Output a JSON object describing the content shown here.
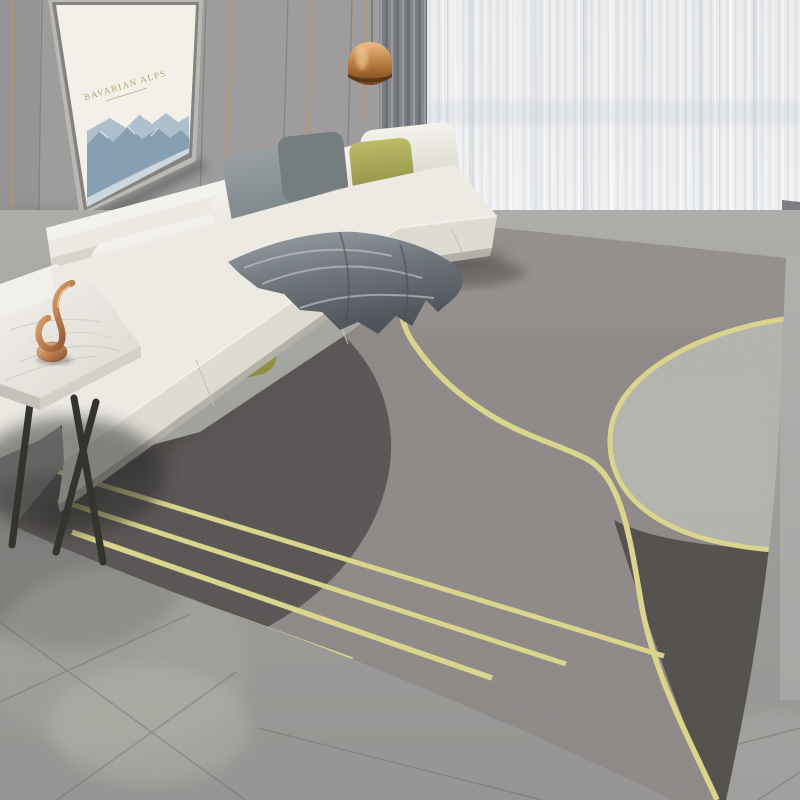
{
  "scene": {
    "type": "photograph",
    "description": "Modern living room: white L-shaped sectional sofa with grey and olive pillows, satin grey throw, framed mountain print on panelled grey wall, copper pendant lamp, grey and sheer white curtains, marble side table with gold sculpture, large grey geometric area rug with gold curved and straight lines on polished grey tile floor"
  },
  "artwork": {
    "title": "BAVARIAN ALPS"
  },
  "objects": {
    "wall_art": "framed mountain print",
    "pendant_lamp": "copper pendant lamp",
    "sofa": "white sectional sofa",
    "throw": "grey satin throw blanket",
    "rug": "grey geometric rug with gold lines",
    "side_table": "marble top side table",
    "ornament": "gold abstract sculpture",
    "curtain_left": "grey drape",
    "curtain_right": "sheer white curtain",
    "floor": "polished grey tile floor"
  },
  "palette": {
    "wall": "#9e9c9d",
    "wallSeam": "#7b797a",
    "goldTrim": "#b99763",
    "artMat": "#f3f0ea",
    "mountainLight": "#adc0cc",
    "mountainDark": "#7f99ab",
    "artGoldText": "#b9a173",
    "curtainGray": "#85878c",
    "sheerBase": "#e9ebed",
    "lampCopper": "#c98f4f",
    "sofaWhite": "#ece9e2",
    "sofaMid": "#dedbd3",
    "sofaBase": "#ccc9c1",
    "pillowDark": "#767d81",
    "pillowGray": "#8e969a",
    "pillowSage": "#96a085",
    "pillowOlive": "#abaa54",
    "blanket": "#7e858b",
    "marble": "#eae7e2",
    "tableLeg": "#34342f",
    "ornament": "#c98e55",
    "rugBase": "#8d8786",
    "rugDark": "#565150",
    "rugDarkBR": "#4f4b49",
    "rugLight": "#b4b4ae",
    "rugGold": "#ddd78a",
    "floor": "#9d9d9a",
    "floorLight": "#b5b6b3",
    "floorSeam": "#6f706d",
    "reflection": "#a4ab9c"
  }
}
